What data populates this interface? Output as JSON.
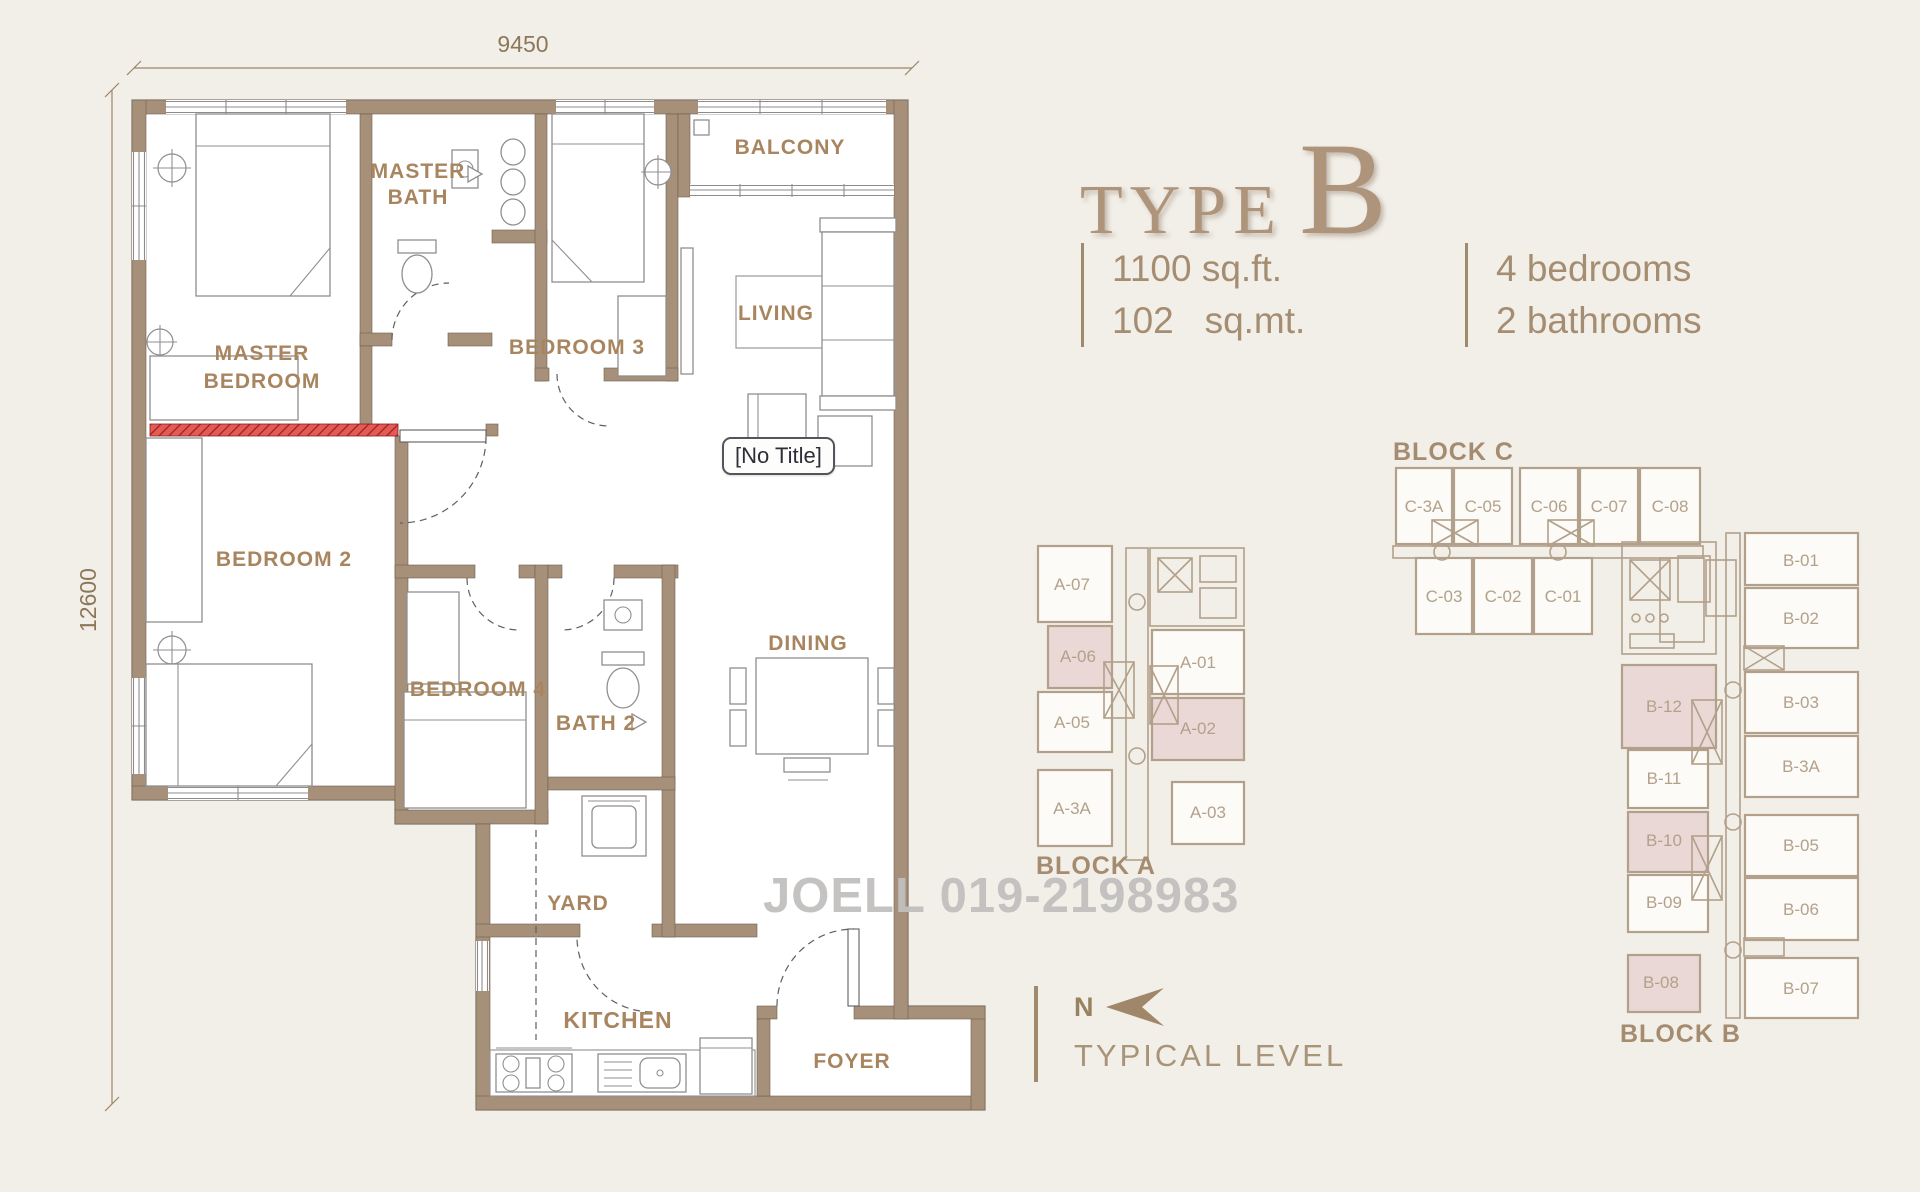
{
  "title": {
    "word": "TYPE",
    "letter": "B"
  },
  "specs": {
    "area_ft": "1100 sq.ft.",
    "area_mt": "102   sq.mt.",
    "bedrooms": "4 bedrooms",
    "bathrooms": "2 bathrooms"
  },
  "dimensions": {
    "width": "9450",
    "height": "12600"
  },
  "plan": {
    "tooltip": "[No Title]",
    "rooms": {
      "master_bath_1": "MASTER",
      "master_bath_2": "BATH",
      "balcony": "BALCONY",
      "master_bedroom_1": "MASTER",
      "master_bedroom_2": "BEDROOM",
      "bedroom3": "BEDROOM 3",
      "living": "LIVING",
      "bedroom2": "BEDROOM 2",
      "bedroom4": "BEDROOM 4",
      "bath2": "BATH 2",
      "dining": "DINING",
      "yard": "YARD",
      "kitchen": "KITCHEN",
      "foyer": "FOYER"
    }
  },
  "watermark": "JOELL 019-2198983",
  "north": {
    "n": "N",
    "caption": "TYPICAL LEVEL"
  },
  "blocks": {
    "a": {
      "label": "BLOCK A",
      "units": [
        {
          "id": "A-07",
          "highlighted": false
        },
        {
          "id": "A-06",
          "highlighted": true
        },
        {
          "id": "A-05",
          "highlighted": false
        },
        {
          "id": "A-3A",
          "highlighted": false
        },
        {
          "id": "A-01",
          "highlighted": false
        },
        {
          "id": "A-02",
          "highlighted": true
        },
        {
          "id": "A-03",
          "highlighted": false
        }
      ]
    },
    "c": {
      "label": "BLOCK C",
      "units": [
        {
          "id": "C-3A",
          "highlighted": false
        },
        {
          "id": "C-05",
          "highlighted": false
        },
        {
          "id": "C-06",
          "highlighted": false
        },
        {
          "id": "C-07",
          "highlighted": false
        },
        {
          "id": "C-08",
          "highlighted": false
        },
        {
          "id": "C-03",
          "highlighted": false
        },
        {
          "id": "C-02",
          "highlighted": false
        },
        {
          "id": "C-01",
          "highlighted": false
        }
      ]
    },
    "b": {
      "label": "BLOCK B",
      "units": [
        {
          "id": "B-01",
          "highlighted": false
        },
        {
          "id": "B-02",
          "highlighted": false
        },
        {
          "id": "B-03",
          "highlighted": false
        },
        {
          "id": "B-3A",
          "highlighted": false
        },
        {
          "id": "B-05",
          "highlighted": false
        },
        {
          "id": "B-06",
          "highlighted": false
        },
        {
          "id": "B-07",
          "highlighted": false
        },
        {
          "id": "B-12",
          "highlighted": true
        },
        {
          "id": "B-11",
          "highlighted": false
        },
        {
          "id": "B-10",
          "highlighted": true
        },
        {
          "id": "B-09",
          "highlighted": false
        },
        {
          "id": "B-08",
          "highlighted": true
        }
      ]
    }
  },
  "colors": {
    "background": "#f2efe8",
    "wall": "#a6907a",
    "label_text": "#a8855f",
    "highlight_unit": "#ead8d6",
    "red_wall": "#e25b55",
    "watermark": "#c1c0be"
  }
}
